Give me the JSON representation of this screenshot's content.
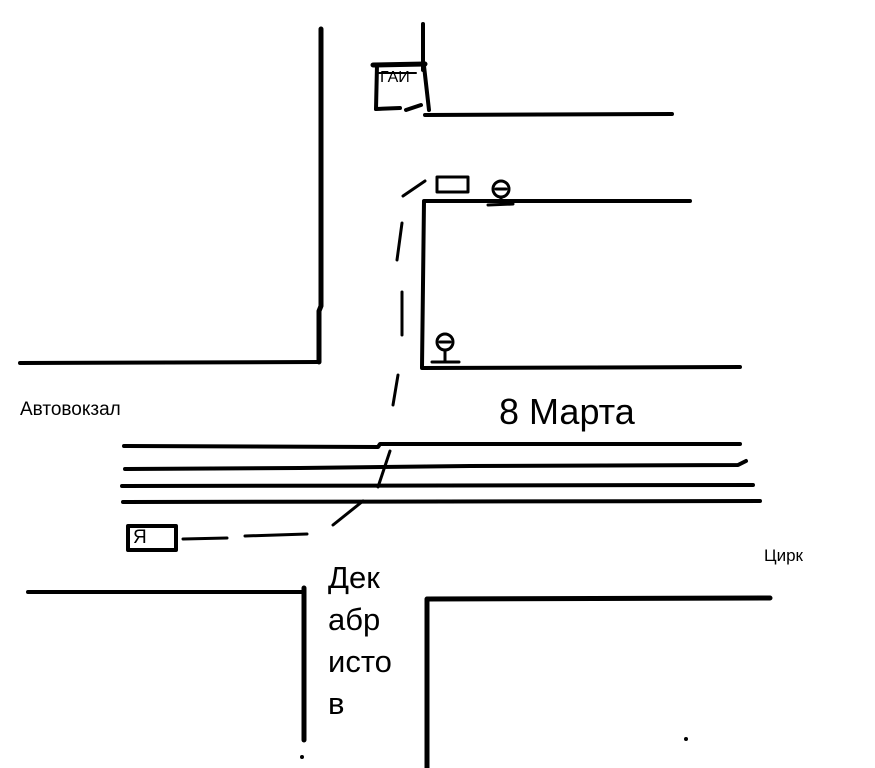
{
  "drawing": {
    "type": "hand-drawn street map",
    "background_color": "#ffffff",
    "ink_color": "#000000",
    "labels": {
      "bus_station": "Автовокзал",
      "street_8_marta": "8 Марта",
      "circus": "Цирк",
      "gai": "ГАИ",
      "me": "Я",
      "dekabristov": [
        "Дек",
        "абр",
        "исто",
        "в"
      ]
    },
    "icons": {
      "upper_sign": "traffic-sign-icon",
      "lower_sign": "traffic-sign-icon"
    }
  }
}
